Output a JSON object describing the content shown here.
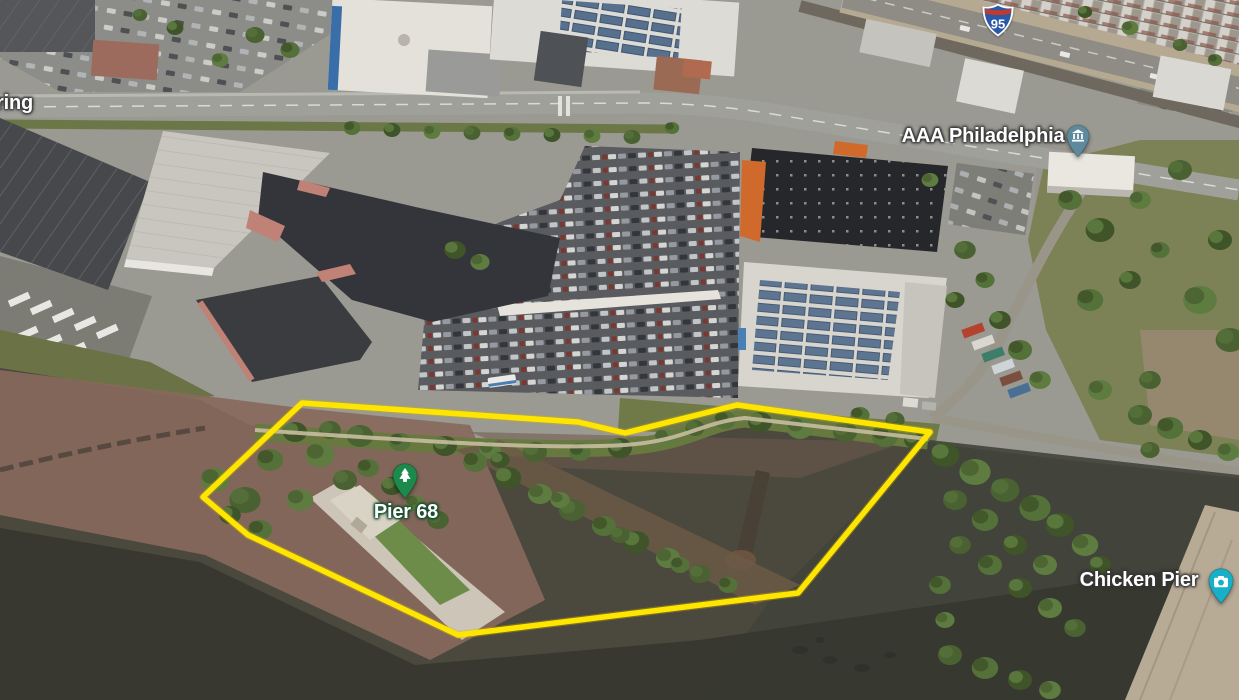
{
  "map": {
    "labels": {
      "partial_left": "ring",
      "aaa": "AAA Philadelphia",
      "pier68": "Pier 68",
      "chicken_pier": "Chicken Pier"
    },
    "shield": {
      "icon": "interstate-shield-icon",
      "number": "95",
      "colors": {
        "body": "#2b58a7",
        "band": "#c03a2d",
        "border": "#ffffff"
      }
    },
    "pins": {
      "aaa": {
        "icon": "civic-building-icon",
        "color": "#5d8b9d"
      },
      "pier68": {
        "icon": "evergreen-tree-icon",
        "color": "#1b8a4c"
      },
      "chicken_pier": {
        "icon": "camera-icon",
        "color": "#17b0c8"
      }
    },
    "selection_polygon": {
      "color": "#ffe600",
      "points": "302,403 578,422 625,433 737,405 930,432 798,593 458,635 248,535 203,497"
    }
  }
}
